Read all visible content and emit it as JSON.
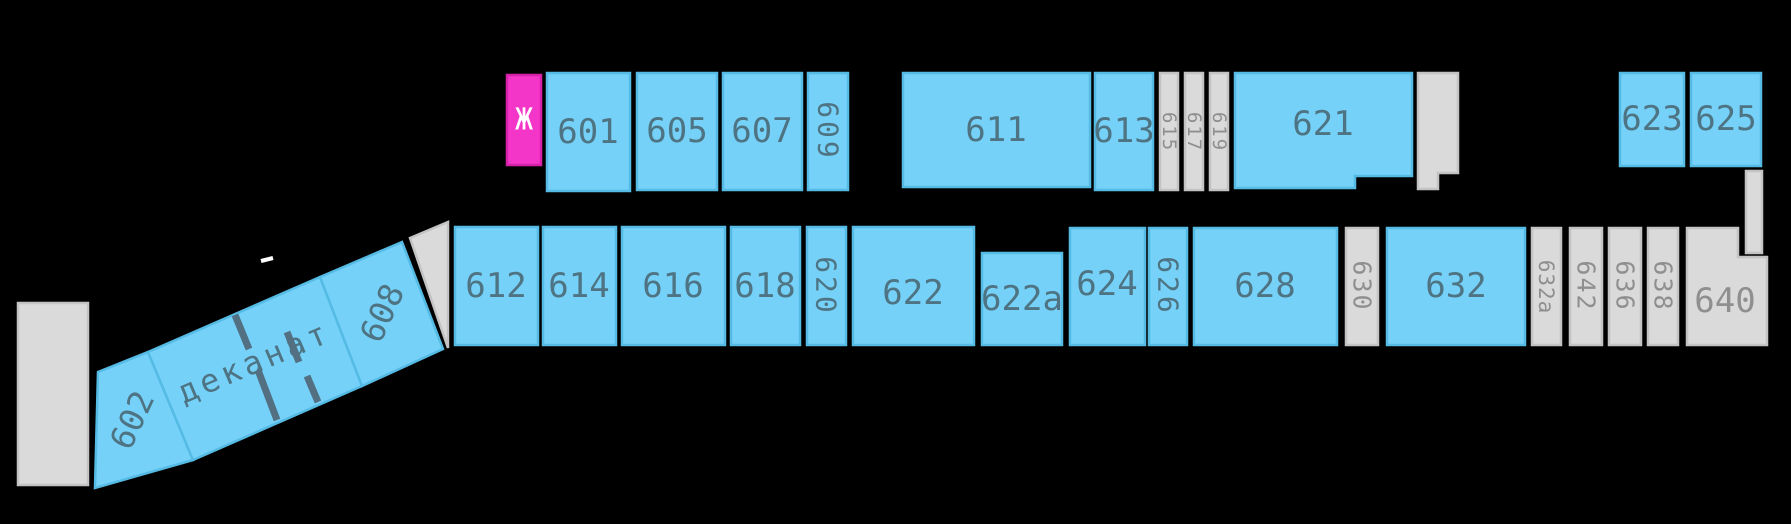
{
  "canvas": {
    "width": 1791,
    "height": 524
  },
  "colors": {
    "bg": "#000000",
    "blue_fill": "#75d1f8",
    "blue_stroke": "#55bbe4",
    "blue_text": "#4e7382",
    "gray_fill": "#dadada",
    "gray_stroke": "#c3c3c3",
    "gray_text": "#8f8f8f",
    "magenta_fill": "#f335c8",
    "magenta_stroke": "#d622ab",
    "white": "#ffffff",
    "wall": "#527082"
  },
  "rooms": [
    {
      "id": "zh",
      "label": "Ж",
      "type": "magenta",
      "rect": [
        507,
        75,
        34,
        90
      ],
      "label_pos": [
        524,
        120
      ],
      "rot": 0,
      "size": 30,
      "text": "white"
    },
    {
      "id": "601",
      "label": "601",
      "type": "blue",
      "rect": [
        547,
        73,
        83,
        118
      ],
      "label_pos": [
        588,
        132
      ]
    },
    {
      "id": "605",
      "label": "605",
      "type": "blue",
      "rect": [
        637,
        73,
        80,
        117
      ],
      "label_pos": [
        677,
        131
      ]
    },
    {
      "id": "607",
      "label": "607",
      "type": "blue",
      "rect": [
        723,
        73,
        79,
        117
      ],
      "label_pos": [
        762,
        131
      ]
    },
    {
      "id": "609",
      "label": "609",
      "type": "blue",
      "rect": [
        808,
        73,
        40,
        117
      ],
      "label_pos": [
        828,
        131
      ],
      "rot": 90,
      "size": 28,
      "spacing": 3
    },
    {
      "id": "611",
      "label": "611",
      "type": "blue",
      "rect": [
        903,
        73,
        187,
        114
      ],
      "label_pos": [
        996,
        130
      ]
    },
    {
      "id": "613",
      "label": "613",
      "type": "blue",
      "rect": [
        1095,
        73,
        58,
        117
      ],
      "label_pos": [
        1124,
        131
      ]
    },
    {
      "id": "615",
      "label": "615",
      "type": "gray",
      "rect": [
        1160,
        73,
        18,
        117
      ],
      "label_pos": [
        1169,
        132
      ],
      "rot": 90,
      "size": 19,
      "spacing": 2,
      "text": "gray"
    },
    {
      "id": "617",
      "label": "617",
      "type": "gray",
      "rect": [
        1185,
        73,
        18,
        117
      ],
      "label_pos": [
        1194,
        132
      ],
      "rot": 90,
      "size": 19,
      "spacing": 2,
      "text": "gray"
    },
    {
      "id": "619",
      "label": "619",
      "type": "gray",
      "rect": [
        1210,
        73,
        18,
        117
      ],
      "label_pos": [
        1219,
        132
      ],
      "rot": 90,
      "size": 19,
      "spacing": 2,
      "text": "gray"
    },
    {
      "id": "621",
      "label": "621",
      "type": "blue",
      "points": "1235,73 1412,73 1412,176 1355,176 1355,188 1235,188",
      "label_pos": [
        1323,
        124
      ]
    },
    {
      "id": "block-top-right",
      "label": "",
      "type": "gray",
      "points": "1418,73 1458,73 1458,173 1438,173 1438,189 1418,189"
    },
    {
      "id": "623",
      "label": "623",
      "type": "blue",
      "rect": [
        1620,
        73,
        64,
        93
      ],
      "label_pos": [
        1652,
        119
      ]
    },
    {
      "id": "625",
      "label": "625",
      "type": "blue",
      "rect": [
        1691,
        73,
        70,
        93
      ],
      "label_pos": [
        1726,
        119
      ]
    },
    {
      "id": "strip-below-625",
      "label": "",
      "type": "gray",
      "rect": [
        1746,
        171,
        16,
        82
      ]
    },
    {
      "id": "612",
      "label": "612",
      "type": "blue",
      "rect": [
        455,
        227,
        83,
        118
      ],
      "label_pos": [
        496,
        286
      ]
    },
    {
      "id": "614",
      "label": "614",
      "type": "blue",
      "rect": [
        543,
        227,
        73,
        118
      ],
      "label_pos": [
        579,
        286
      ]
    },
    {
      "id": "616",
      "label": "616",
      "type": "blue",
      "rect": [
        622,
        227,
        103,
        118
      ],
      "label_pos": [
        673,
        286
      ]
    },
    {
      "id": "618",
      "label": "618",
      "type": "blue",
      "rect": [
        731,
        227,
        69,
        118
      ],
      "label_pos": [
        765,
        286
      ]
    },
    {
      "id": "620",
      "label": "620",
      "type": "blue",
      "rect": [
        807,
        227,
        39,
        118
      ],
      "label_pos": [
        826,
        286
      ],
      "rot": 90,
      "size": 28,
      "spacing": 3
    },
    {
      "id": "622",
      "label": "622",
      "type": "blue",
      "rect": [
        853,
        227,
        121,
        118
      ],
      "label_pos": [
        913,
        293
      ]
    },
    {
      "id": "622a",
      "label": "622a",
      "type": "blue",
      "rect": [
        982,
        253,
        80,
        92
      ],
      "label_pos": [
        1022,
        299
      ]
    },
    {
      "id": "624",
      "label": "624",
      "type": "blue",
      "rect": [
        1070,
        228,
        75,
        117
      ],
      "label_pos": [
        1107,
        284
      ]
    },
    {
      "id": "626",
      "label": "626",
      "type": "blue",
      "rect": [
        1149,
        228,
        38,
        117
      ],
      "label_pos": [
        1168,
        286
      ],
      "rot": 90,
      "size": 28,
      "spacing": 3
    },
    {
      "id": "628",
      "label": "628",
      "type": "blue",
      "rect": [
        1194,
        228,
        143,
        117
      ],
      "label_pos": [
        1265,
        286
      ]
    },
    {
      "id": "630",
      "label": "630",
      "type": "gray",
      "rect": [
        1346,
        228,
        32,
        117
      ],
      "label_pos": [
        1362,
        286
      ],
      "rot": 90,
      "size": 25,
      "spacing": 2,
      "text": "gray"
    },
    {
      "id": "632",
      "label": "632",
      "type": "blue",
      "rect": [
        1387,
        228,
        138,
        117
      ],
      "label_pos": [
        1456,
        286
      ]
    },
    {
      "id": "632a",
      "label": "632a",
      "type": "gray",
      "rect": [
        1532,
        228,
        29,
        117
      ],
      "label_pos": [
        1546,
        287
      ],
      "rot": 90,
      "size": 21,
      "spacing": 1,
      "text": "gray"
    },
    {
      "id": "642",
      "label": "642",
      "type": "gray",
      "rect": [
        1570,
        228,
        32,
        117
      ],
      "label_pos": [
        1586,
        286
      ],
      "rot": 90,
      "size": 25,
      "spacing": 2,
      "text": "gray"
    },
    {
      "id": "636",
      "label": "636",
      "type": "gray",
      "rect": [
        1609,
        228,
        32,
        117
      ],
      "label_pos": [
        1625,
        286
      ],
      "rot": 90,
      "size": 25,
      "spacing": 2,
      "text": "gray"
    },
    {
      "id": "638",
      "label": "638",
      "type": "gray",
      "rect": [
        1648,
        228,
        30,
        117
      ],
      "label_pos": [
        1663,
        286
      ],
      "rot": 90,
      "size": 25,
      "spacing": 2,
      "text": "gray"
    },
    {
      "id": "640",
      "label": "640",
      "type": "gray",
      "points": "1687,228 1738,228 1738,257 1767,257 1767,345 1687,345",
      "label_pos": [
        1725,
        301
      ],
      "size": 34,
      "text": "gray"
    },
    {
      "id": "block-left",
      "label": "",
      "type": "gray",
      "rect": [
        18,
        303,
        70,
        182
      ]
    },
    {
      "id": "602",
      "label": "602",
      "type": "blue",
      "points": "98,372 148,352 193,460 95,488",
      "label_pos": [
        132,
        420
      ],
      "rot": -65,
      "size": 33
    },
    {
      "id": "dekanat",
      "label": "деканат",
      "type": "blue",
      "points": "148,352 320,277 362,386 193,460",
      "label_pos": [
        254,
        362
      ],
      "rot": -23,
      "size": 32,
      "spacing": 4
    },
    {
      "id": "608",
      "label": "608",
      "type": "blue",
      "points": "320,277 402,242 443,349 362,386",
      "label_pos": [
        382,
        313
      ],
      "rot": -65,
      "size": 33
    },
    {
      "id": "corner-wedge",
      "label": "",
      "type": "gray",
      "points": "410,238 448,222 448,348"
    }
  ],
  "interior_walls": [
    {
      "x1": 235,
      "y1": 315,
      "x2": 249,
      "y2": 349
    },
    {
      "x1": 258,
      "y1": 370,
      "x2": 277,
      "y2": 420
    },
    {
      "x1": 287,
      "y1": 332,
      "x2": 299,
      "y2": 362
    },
    {
      "x1": 307,
      "y1": 376,
      "x2": 318,
      "y2": 402
    }
  ],
  "ticks": [
    {
      "x1": 261,
      "y1": 261,
      "x2": 273,
      "y2": 258
    }
  ]
}
